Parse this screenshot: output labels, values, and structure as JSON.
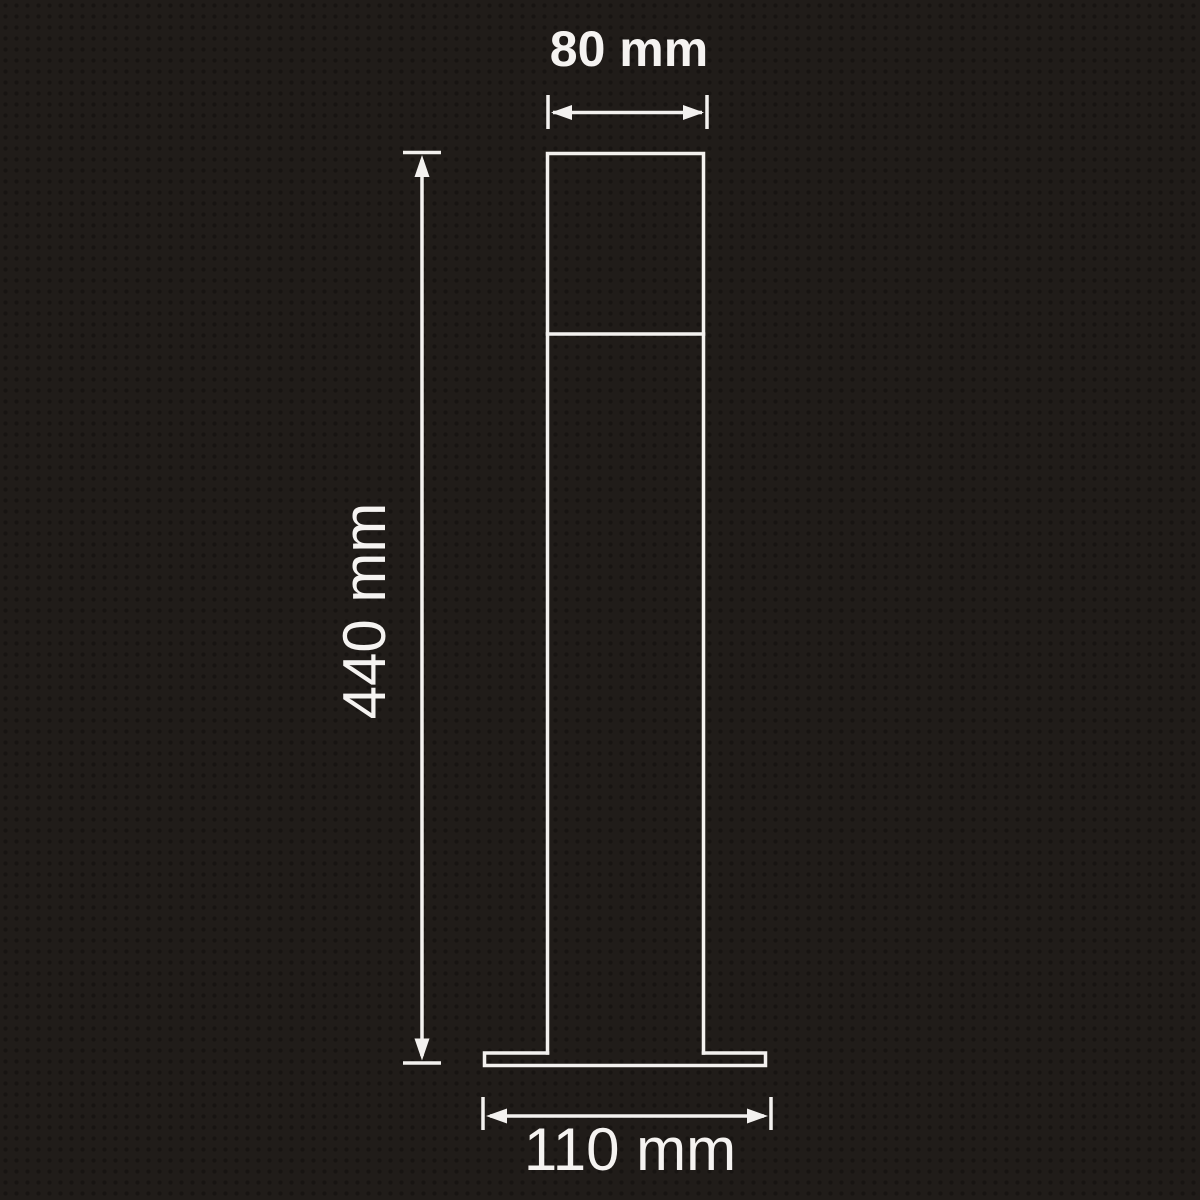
{
  "diagram": {
    "background_color": "#201c19",
    "line_color": "#f3f1ef",
    "label_color": "#f5f3f1",
    "dimensions": {
      "top_width": {
        "label": "80 mm"
      },
      "height": {
        "label": "440 mm"
      },
      "base_width": {
        "label": "110 mm"
      }
    }
  }
}
